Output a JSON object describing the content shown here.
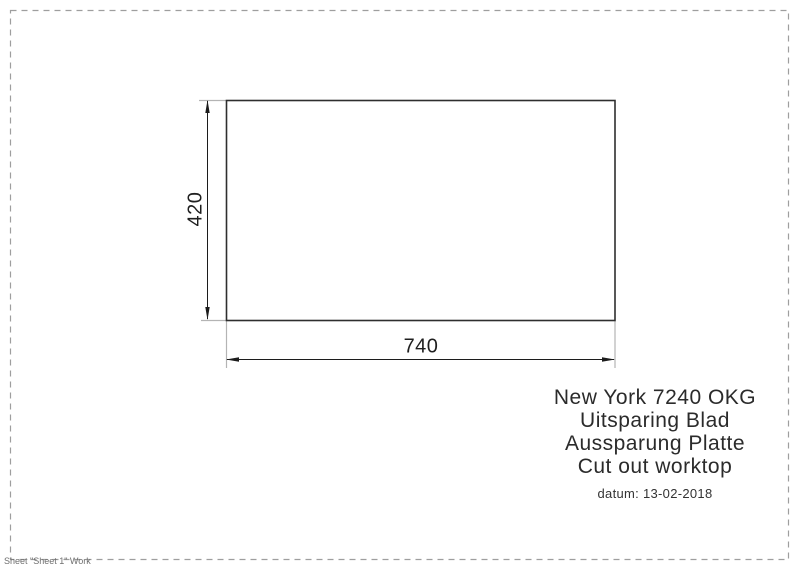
{
  "drawing": {
    "shape": "cut-out rectangle",
    "width_dim": "740",
    "height_dim": "420"
  },
  "title_block": {
    "lines": [
      "New York 7240 OKG",
      "Uitsparing Blad",
      "Aussparung Platte",
      "Cut out worktop"
    ],
    "date": "datum: 13-02-2018"
  },
  "footer": {
    "sheet_label": "Sheet \"Sheet 1\" Work"
  },
  "colors": {
    "outline": "#2e2e2e",
    "dimension": "#1c1c1c",
    "extension": "#b4b4b4",
    "border": "#9e9e9e",
    "text": "#2b2b2b",
    "footer_text": "#6e6e6e",
    "background": "#ffffff"
  }
}
